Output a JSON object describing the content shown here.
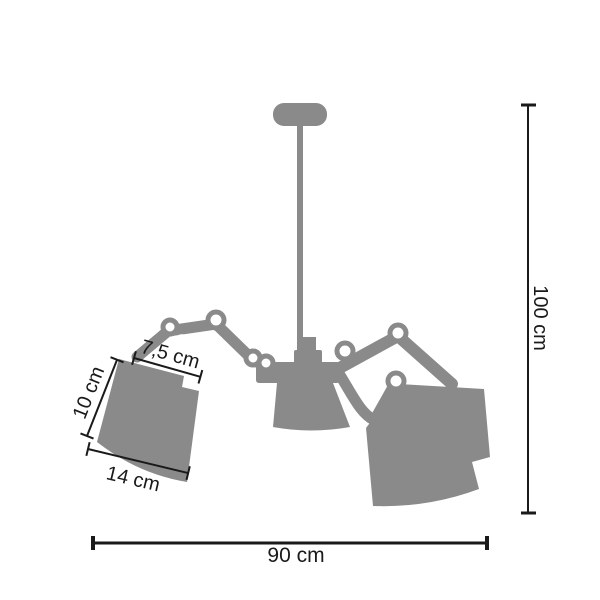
{
  "diagram": {
    "kind": "product-dimension-diagram",
    "product": "articulated three-shade chandelier silhouette",
    "colors": {
      "background": "#ffffff",
      "silhouette": "#8a8a8a",
      "dimension_lines": "#1a1a1a"
    }
  },
  "dimensions": {
    "height": {
      "label": "100 cm",
      "value": 100,
      "unit": "cm"
    },
    "width": {
      "label": "90 cm",
      "value": 90,
      "unit": "cm"
    },
    "shade_top": {
      "label": "7,5 cm",
      "value": 7.5,
      "unit": "cm"
    },
    "shade_side": {
      "label": "10 cm",
      "value": 10,
      "unit": "cm"
    },
    "shade_bottom": {
      "label": "14 cm",
      "value": 14,
      "unit": "cm"
    }
  }
}
